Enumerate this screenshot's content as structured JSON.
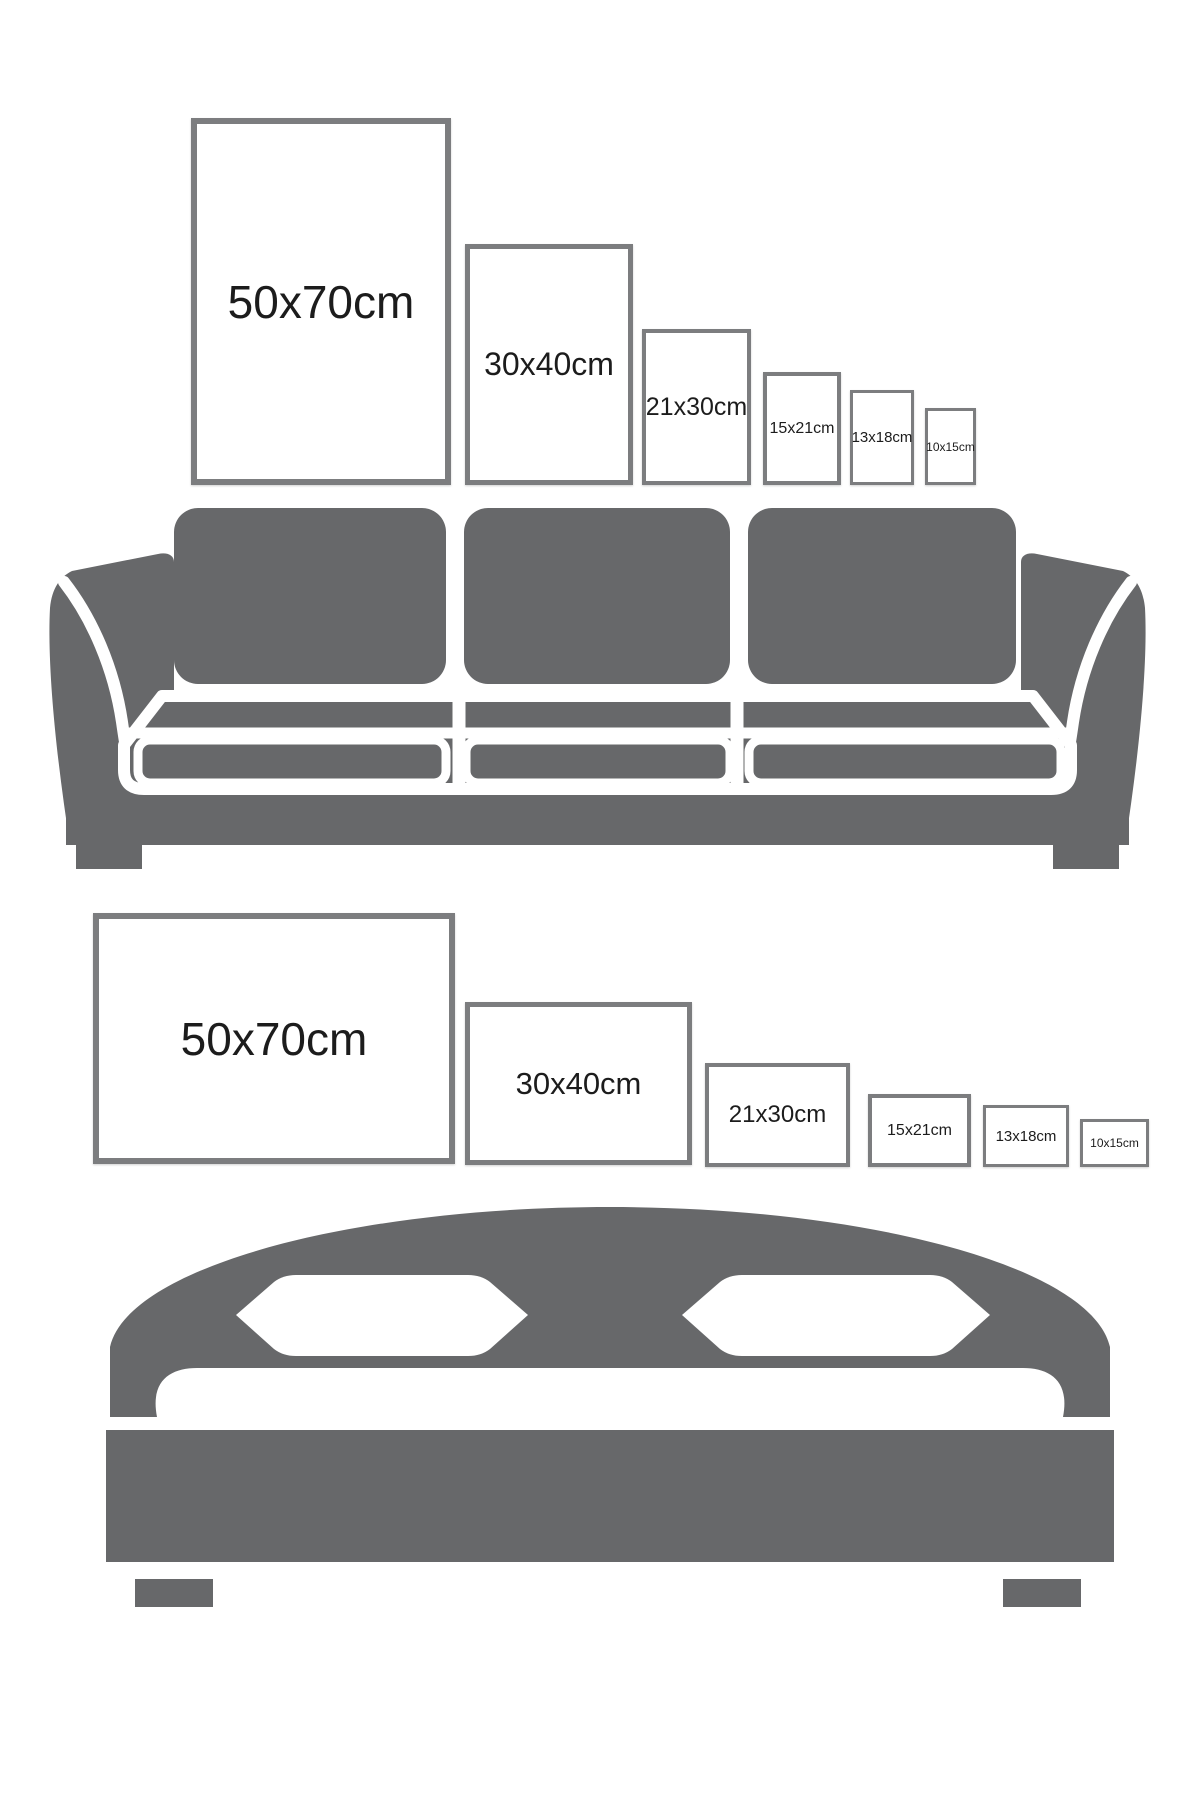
{
  "colors": {
    "furniture_gray": "#67686a",
    "frame_border": "#7c7d7f",
    "label_text": "#1c1c1c",
    "background": "#ffffff"
  },
  "sofa_section": {
    "illustration": "three-seat-sofa",
    "frame_orientation": "portrait",
    "frames": [
      {
        "label": "50x70cm"
      },
      {
        "label": "30x40cm"
      },
      {
        "label": "21x30cm"
      },
      {
        "label": "15x21cm"
      },
      {
        "label": "13x18cm"
      },
      {
        "label": "10x15cm"
      }
    ]
  },
  "bed_section": {
    "illustration": "double-bed",
    "frame_orientation": "landscape",
    "frames": [
      {
        "label": "50x70cm"
      },
      {
        "label": "30x40cm"
      },
      {
        "label": "21x30cm"
      },
      {
        "label": "15x21cm"
      },
      {
        "label": "13x18cm"
      },
      {
        "label": "10x15cm"
      }
    ]
  }
}
